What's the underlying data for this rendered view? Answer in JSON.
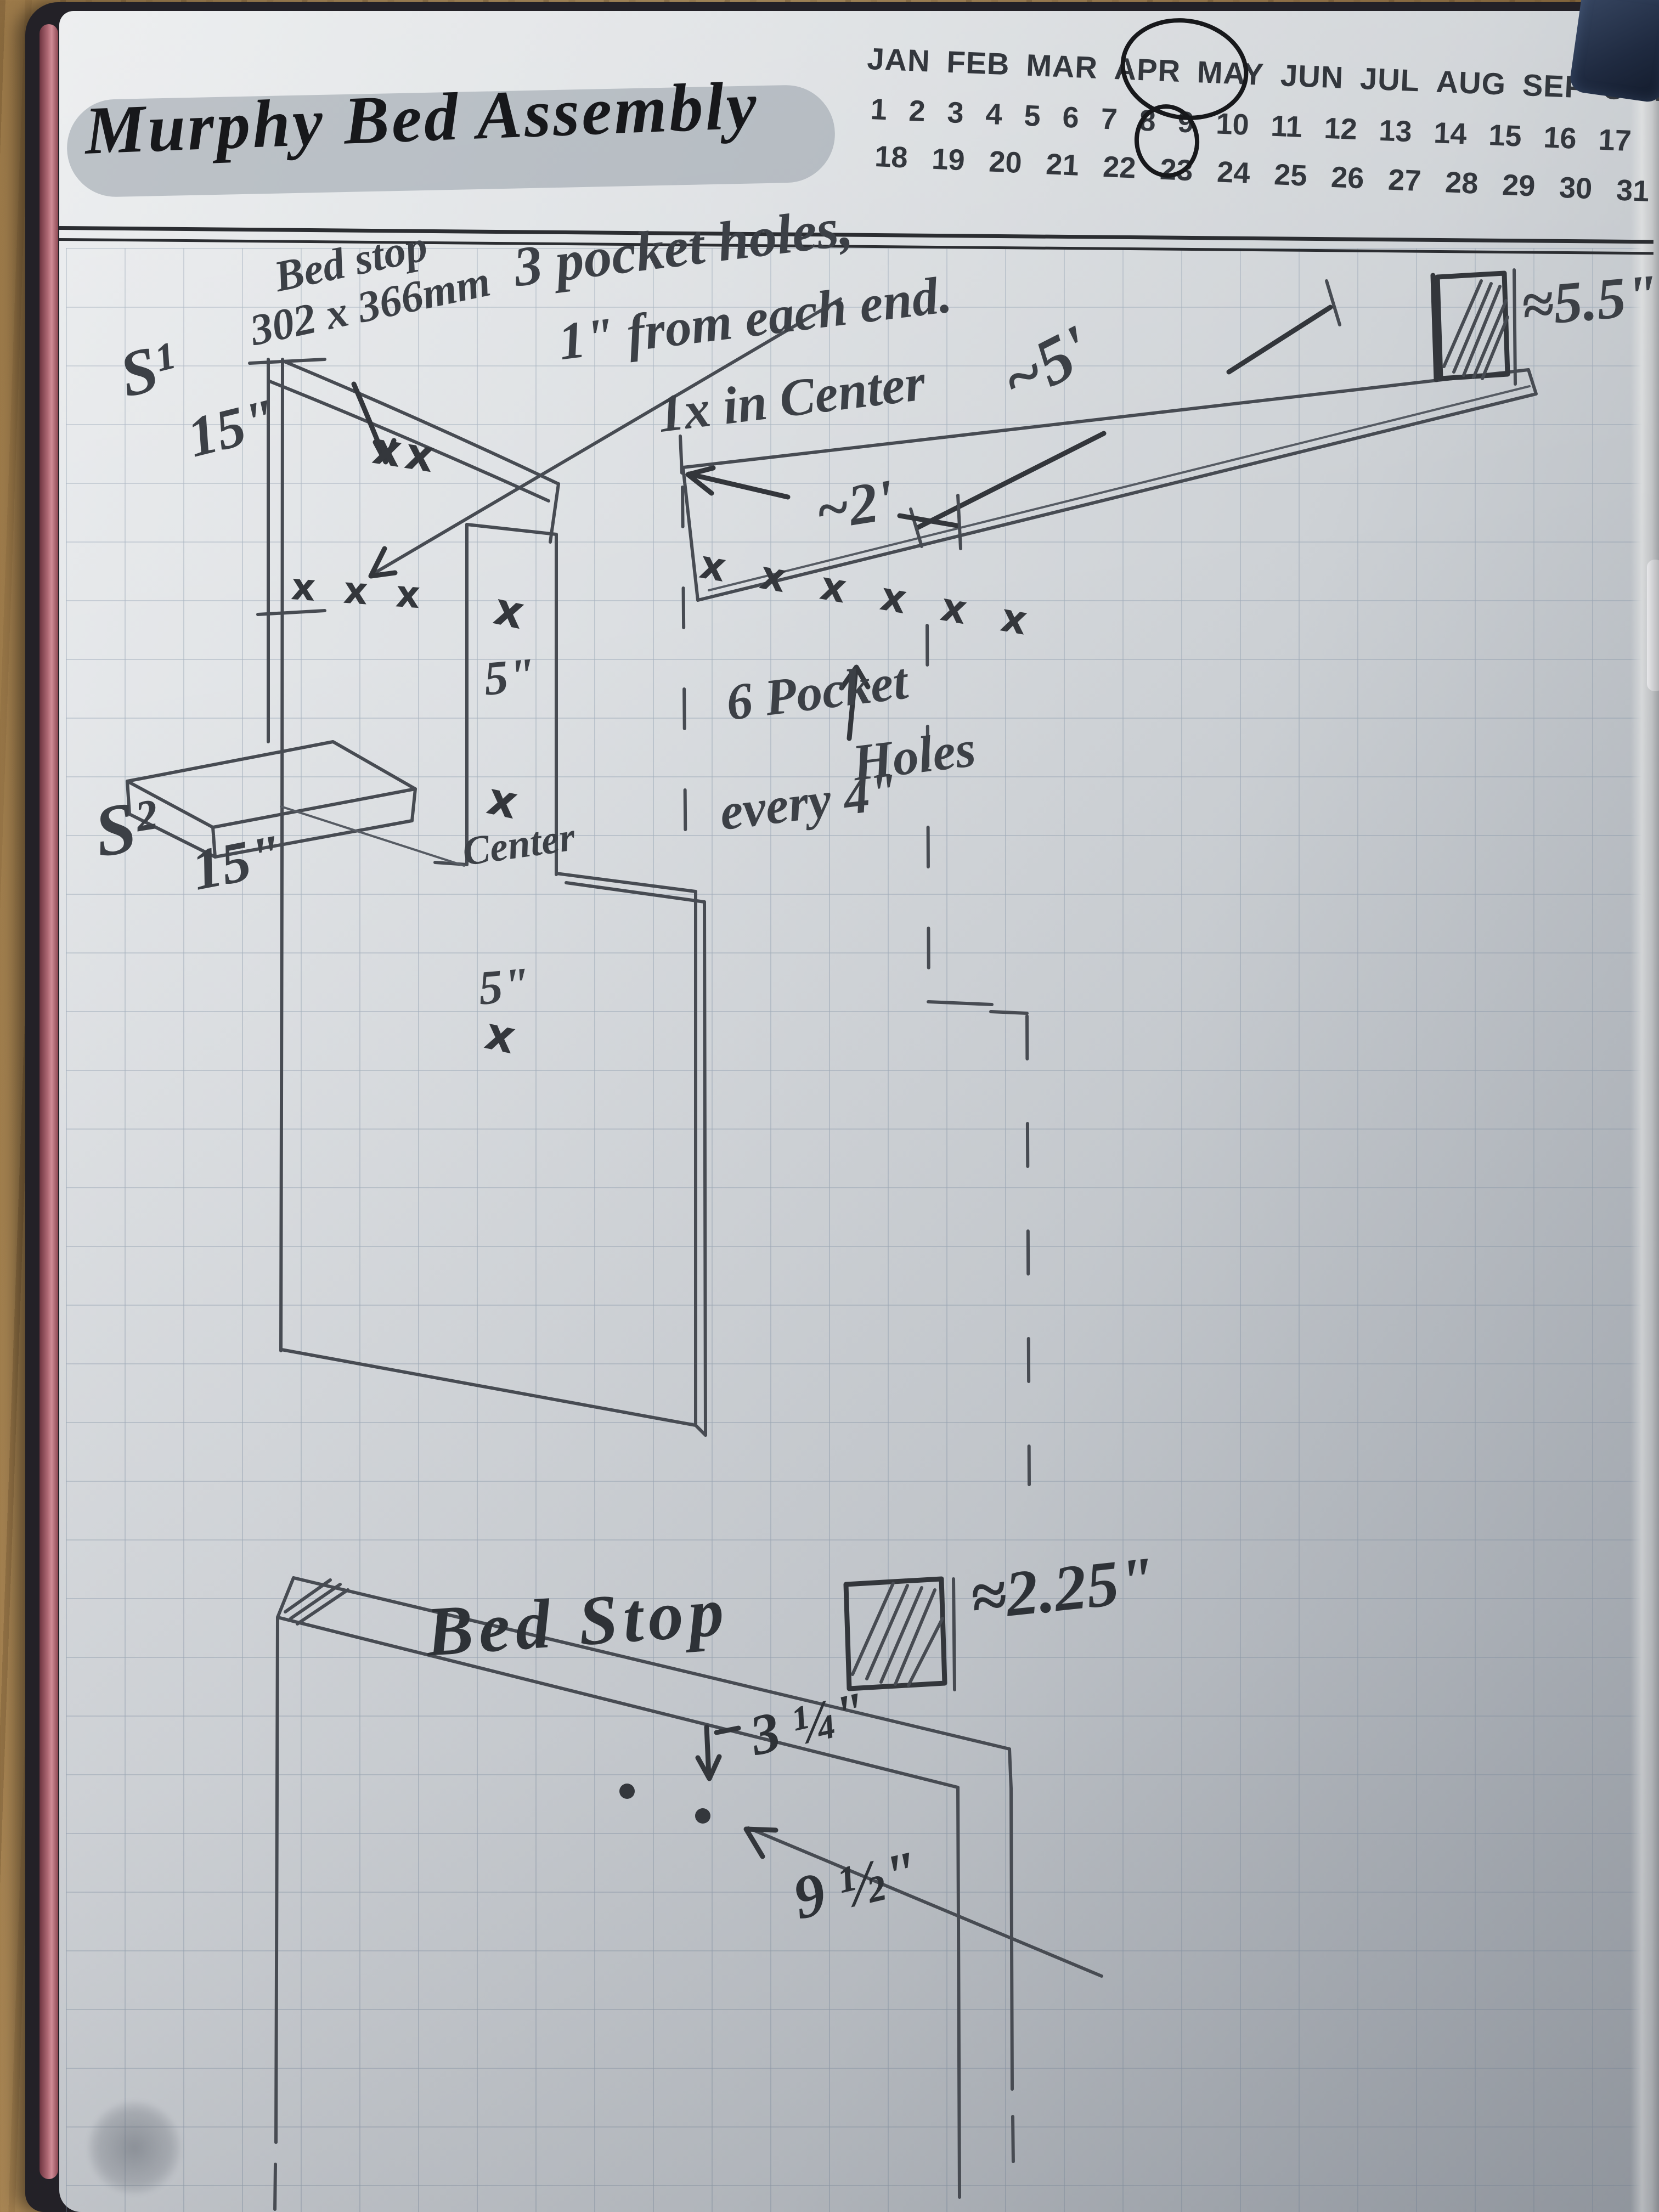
{
  "page": {
    "title": "Murphy Bed Assembly"
  },
  "calendar": {
    "months": [
      "JAN",
      "FEB",
      "MAR",
      "APR",
      "MAY",
      "JUN",
      "JUL",
      "AUG",
      "SEP",
      "OCT",
      "NOV",
      "DEC"
    ],
    "selected_month": "MAY",
    "days_row1": [
      "1",
      "2",
      "3",
      "4",
      "5",
      "6",
      "7",
      "8",
      "9",
      "10",
      "11",
      "12",
      "13",
      "14",
      "15",
      "16",
      "17"
    ],
    "days_row2": [
      "18",
      "19",
      "20",
      "21",
      "22",
      "23",
      "24",
      "25",
      "26",
      "27",
      "28",
      "29",
      "30",
      "31"
    ],
    "selected_day": "8"
  },
  "sketch": {
    "notes": {
      "bed_stop_line1": "Bed stop",
      "bed_stop_line2": "302 x 366mm",
      "pocket3_line1": "3 pocket holes,",
      "pocket3_line2": "1\" from each end.",
      "pocket3_line3": "1x in Center",
      "pocket6_line1": "6 Pocket",
      "pocket6_line2": "Holes",
      "pocket6_line3": "every 4\""
    },
    "labels": {
      "side1": "S¹",
      "side1_height": "15\"",
      "side2": "S²",
      "side2_height": "15\"",
      "strip_x_top": "x",
      "strip_dim_top": "5\"",
      "strip_x_mid": "x",
      "strip_center_label": "Center",
      "strip_dim_bottom": "5\"",
      "strip_x_bottom": "x",
      "plank_length": "~5'",
      "plank_width": "≈5.5\"",
      "headboard_length": "~2'",
      "bed_stop_title": "Bed Stop",
      "bed_stop_width": "≈2.25\"",
      "hole_offset": "3 ¼\"",
      "hole_spacing": "9 ½\""
    },
    "marks": {
      "pair": "xx",
      "triple": "x x x",
      "row_of_six": "x x x x x x"
    }
  },
  "colors": {
    "pencil": "#474b52",
    "ink": "#17181b",
    "paper": "#d9dde1",
    "grid_line": "#7e90a4",
    "highlight": "#969ea8",
    "wood": "#b5925f",
    "cover": "#232127",
    "spine_red": "#b06a75"
  }
}
